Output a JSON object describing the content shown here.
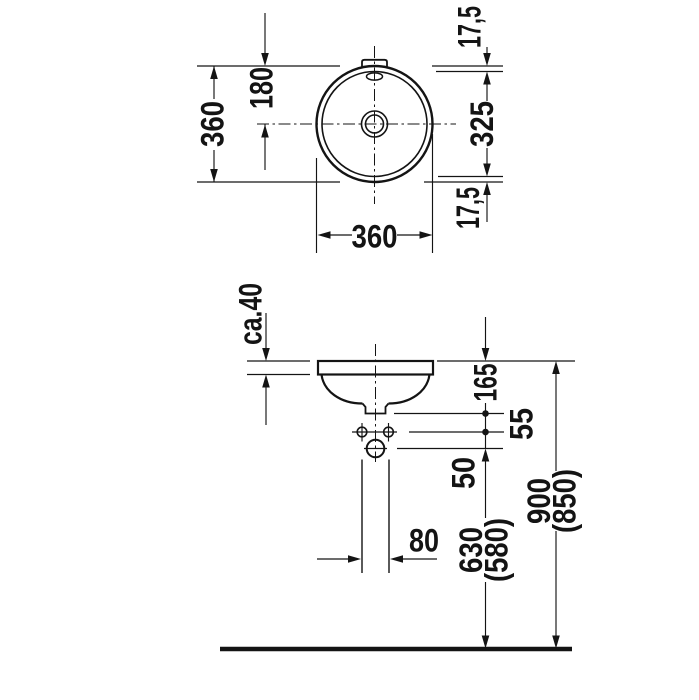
{
  "meta": {
    "type": "technical dimension drawing",
    "subject": "round built-in washbasin, top view and front elevation",
    "background_color": "#ffffff",
    "line_color": "#141414"
  },
  "top_view": {
    "labels": {
      "overall_height": "360",
      "center_from_top": "180",
      "rim_offset_top": "17,5",
      "inner_diameter": "325",
      "rim_offset_bottom": "17,5",
      "overall_width": "360"
    }
  },
  "front_view": {
    "labels": {
      "counter_thickness": "ca.40",
      "rim_to_outlet": "165",
      "outlet_to_holes": "55",
      "holes_to_trap": "50",
      "pipe_width": "80",
      "trap_to_floor": "630",
      "trap_to_floor_variant": "(580)",
      "rim_to_floor": "900",
      "rim_to_floor_variant": "(850)"
    }
  }
}
